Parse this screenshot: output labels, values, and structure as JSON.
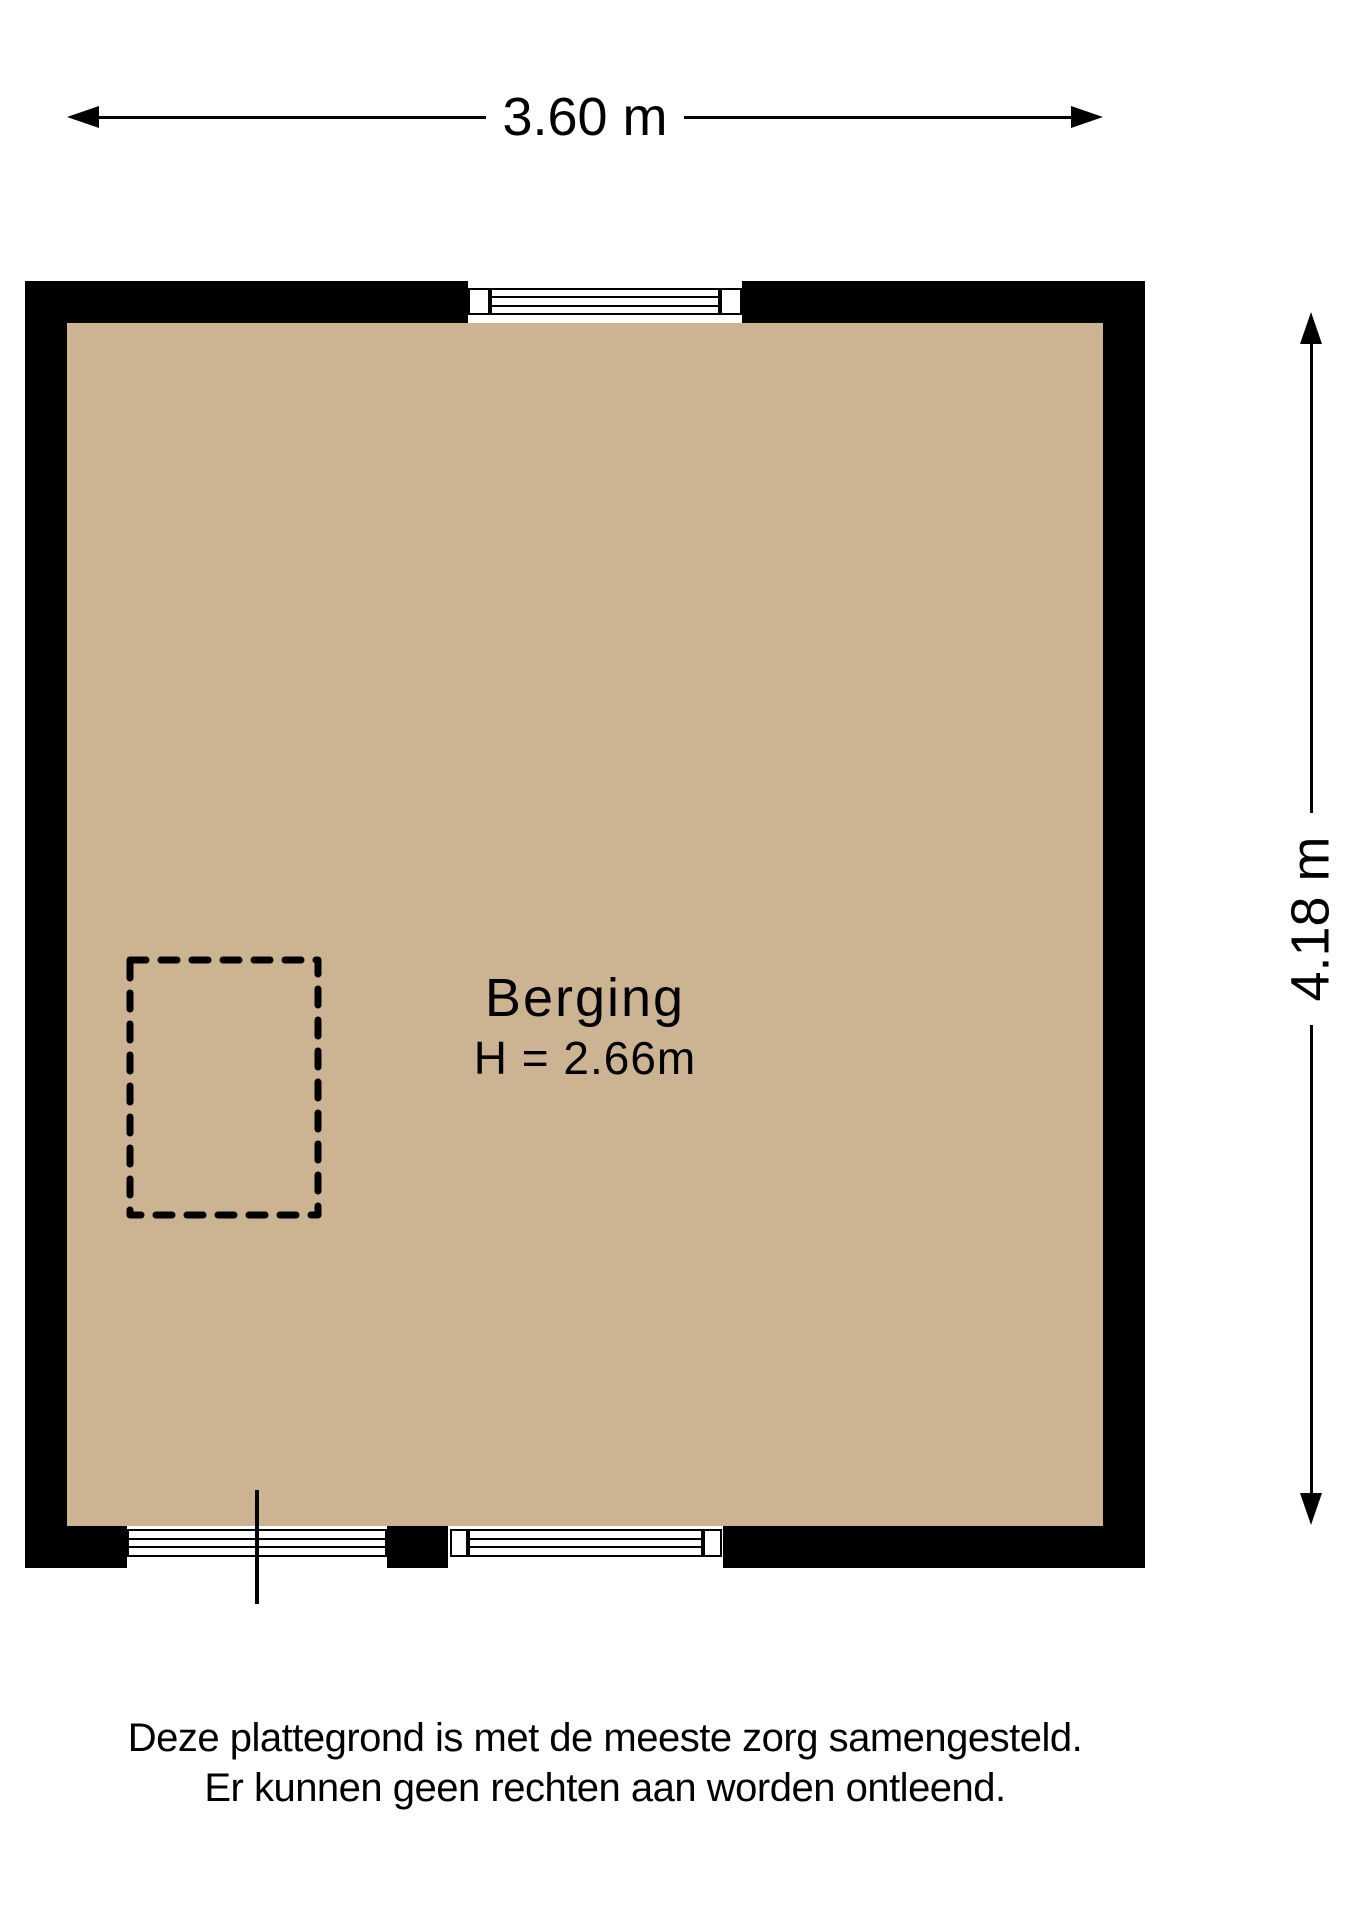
{
  "dimensions": {
    "width_label": "3.60 m",
    "height_label": "4.18 m"
  },
  "room": {
    "name": "Berging",
    "height_label": "H = 2.66m"
  },
  "disclaimer": {
    "line1": "Deze plattegrond is met de meeste zorg samengesteld.",
    "line2": "Er kunnen geen rechten aan worden ontleend."
  },
  "colors": {
    "floor": "#ccb392",
    "wall": "#000000",
    "background": "#ffffff",
    "text": "#000000"
  }
}
